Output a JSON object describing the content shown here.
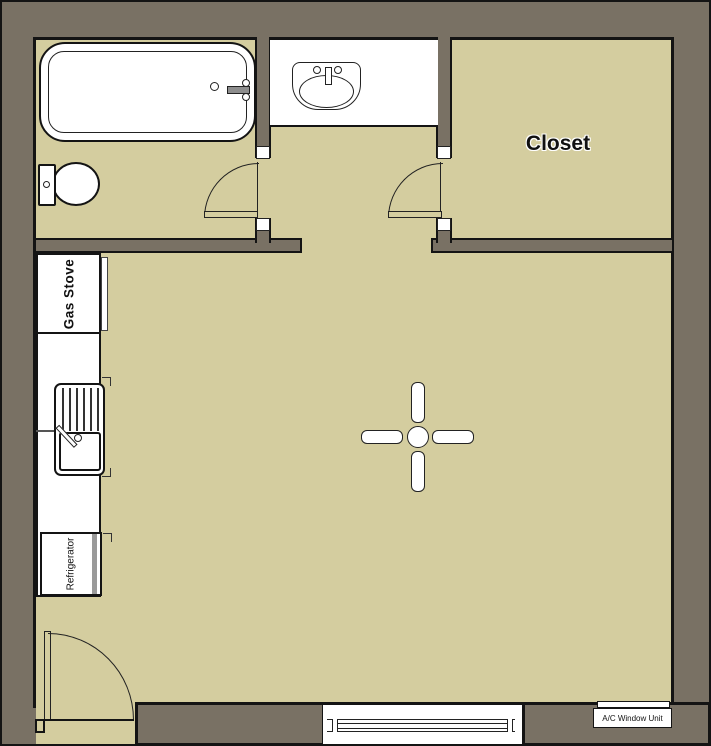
{
  "plan": {
    "type": "floor-plan",
    "rooms": [
      {
        "name": "bathroom",
        "label": ""
      },
      {
        "name": "closet",
        "label": "Closet"
      },
      {
        "name": "main-room",
        "label": ""
      }
    ]
  },
  "labels": {
    "closet": "Closet",
    "gas_stove": "Gas Stove",
    "refrigerator": "Refrigerator",
    "ac_window_unit": "A/C Window Unit"
  },
  "colors": {
    "wall": "#797164",
    "floor": "#d4cd9f",
    "outline": "#141414",
    "fixture": "#ffffff"
  }
}
